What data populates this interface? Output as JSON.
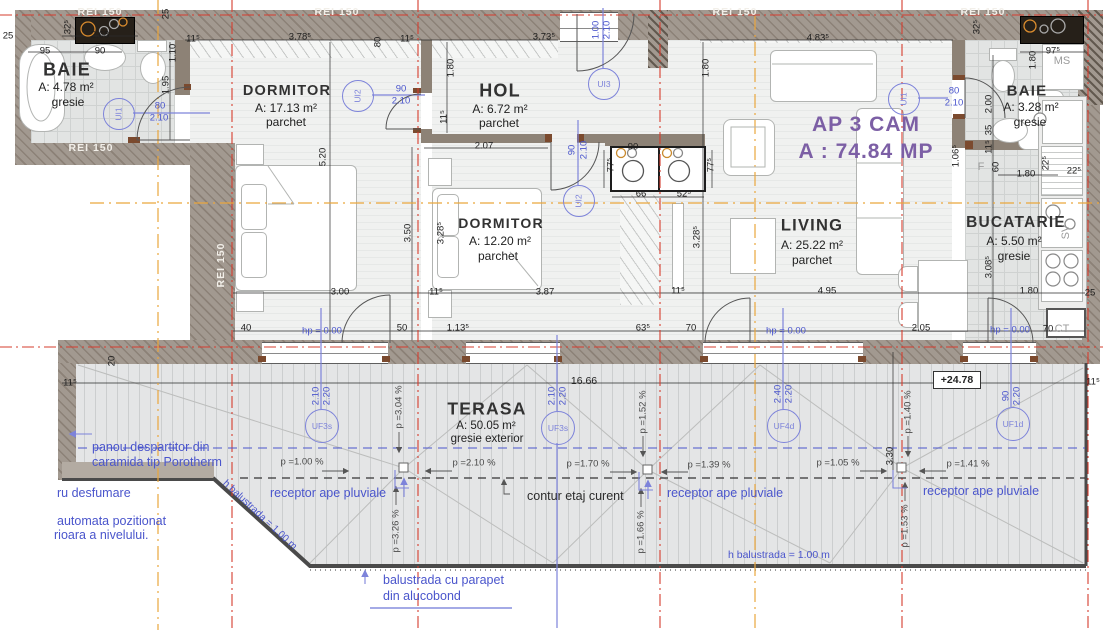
{
  "title": {
    "line1": "AP 3 CAM",
    "line2": "A : 74.84 MP"
  },
  "fire_rating": "REI 150",
  "elevation": "+24.78",
  "rooms": [
    {
      "name": "BAIE",
      "area": "A: 4.78 m²",
      "floor": "gresie"
    },
    {
      "name": "DORMITOR",
      "area": "A: 17.13 m²",
      "floor": "parchet"
    },
    {
      "name": "HOL",
      "area": "A: 6.72 m²",
      "floor": "parchet"
    },
    {
      "name": "DORMITOR",
      "area": "A: 12.20 m²",
      "floor": "parchet"
    },
    {
      "name": "LIVING",
      "area": "A: 25.22 m²",
      "floor": "parchet"
    },
    {
      "name": "BAIE",
      "area": "A: 3.28 m²",
      "floor": "gresie"
    },
    {
      "name": "BUCATARIE",
      "area": "A: 5.50 m²",
      "floor": "gresie"
    },
    {
      "name": "TERASA",
      "area": "A: 50.05 m²",
      "floor": "gresie exterior"
    }
  ],
  "door_tags": [
    "UI1",
    "UI2",
    "UI2",
    "UI3",
    "UI1"
  ],
  "window_tags": [
    "UF3s",
    "UF3s",
    "UF4d",
    "UF1d"
  ],
  "slopes": [
    "p =1.00 %",
    "p =2.10 %",
    "p =1.70 %",
    "p =1.39 %",
    "p =1.05 %",
    "p =1.41 %",
    "p =3.04 %",
    "p =1.52 %",
    "p =1.40 %",
    "p =3.26 %",
    "p =1.66 %",
    "p =1.53 %"
  ],
  "equip": {
    "ms": "MS",
    "f": "F",
    "sv": "SV",
    "ct": "CT"
  },
  "ann": {
    "panou1": "panou despartitor din",
    "panou2": "caramida tip Porotherm",
    "receptor": "receptor ape pluviale",
    "contur": "contur etaj curent",
    "hbal": "h balustrada = 1.00 m",
    "balu1": "balustrada cu parapet",
    "balu2": "din alucobond",
    "desf1": "ru desfumare",
    "desf2": "automata pozitionat",
    "desf3": "rioara a nivelului."
  },
  "dims": [
    "25",
    "95",
    "90",
    "2.68",
    "32⁵",
    "25",
    "1.10",
    "1.95",
    "11⁵",
    "3.78⁵",
    "80",
    "11⁵",
    "3.73⁵",
    "4.83⁵",
    "32⁵",
    "97⁵",
    "1.80",
    "11⁵",
    "1.80",
    "1.80",
    "2.00",
    "35",
    "11⁵",
    "1.06⁵",
    "60",
    "1.80",
    "22⁵",
    "22⁵",
    "3.08⁵",
    "1.80",
    "25",
    "2.05",
    "70",
    "hp = 0.00",
    "4.95",
    "hp = 0.00",
    "3.28⁵",
    "11⁵",
    "63⁵",
    "70",
    "66",
    "52⁵",
    "77⁵",
    "77⁵",
    "90",
    "5.20",
    "3.50",
    "3.00",
    "40",
    "50",
    "11⁵",
    "1.13⁵",
    "hp = 0.00",
    "3.28⁵",
    "2.07",
    "3.87",
    "16.66",
    "11⁵",
    "20",
    "11⁵",
    "3.30",
    "2.10",
    "2.20",
    "2.10",
    "2.20",
    "2.40",
    "2.20",
    "90",
    "2.20",
    "80",
    "2.10",
    "90",
    "2.10",
    "90",
    "2.10",
    "1.00",
    "2.10",
    "80",
    "2.10"
  ]
}
